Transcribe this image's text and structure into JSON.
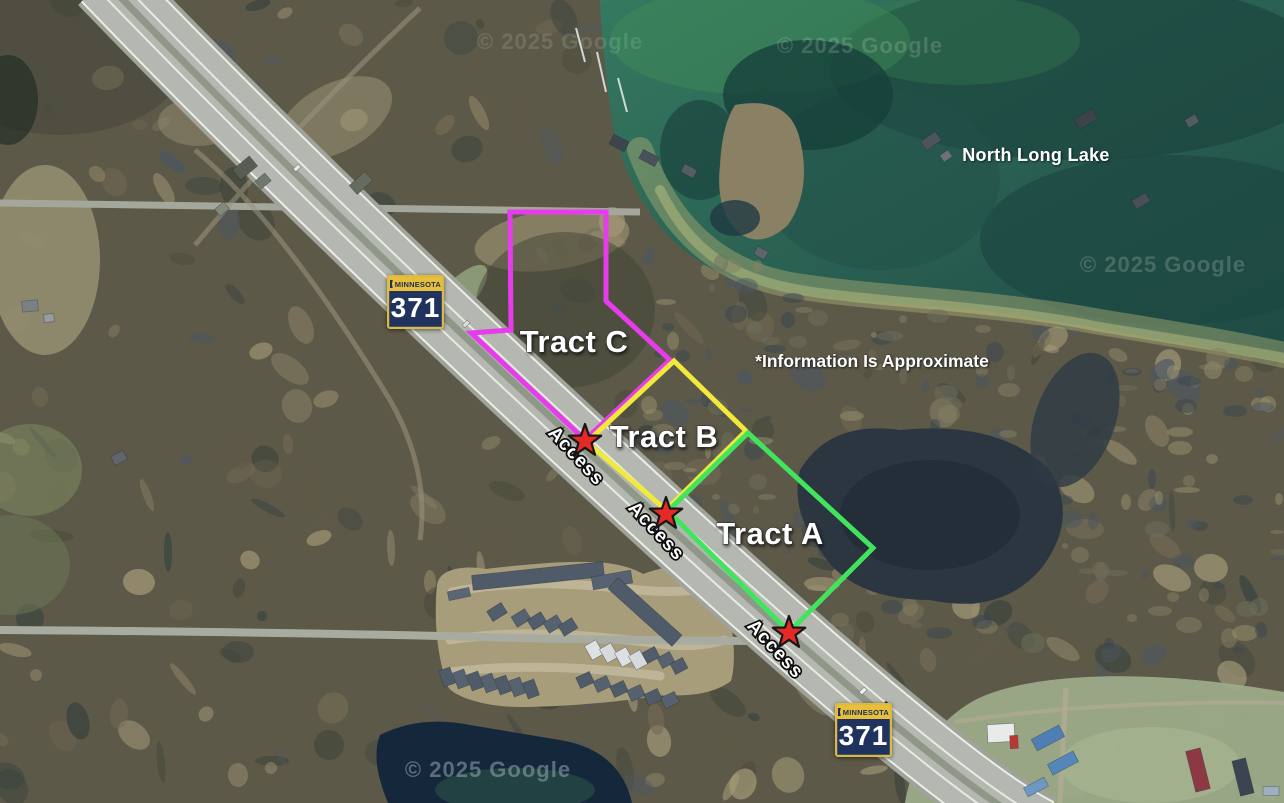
{
  "map": {
    "lake_label": {
      "text": "North Long Lake",
      "x": 1036,
      "y": 161
    },
    "disclaimer": {
      "text": "*Information Is Approximate",
      "x": 872,
      "y": 367
    },
    "watermarks": [
      {
        "text": "© 2025 Google",
        "x": 560,
        "y": 49,
        "opacity": 0.16,
        "color": "#cfe0d8"
      },
      {
        "text": "© 2025 Google",
        "x": 860,
        "y": 53,
        "opacity": 0.2,
        "color": "#cfe0d8"
      },
      {
        "text": "© 2025 Google",
        "x": 1163,
        "y": 272,
        "opacity": 0.22,
        "color": "#d4e2cf"
      },
      {
        "text": "© 2025 Google",
        "x": 488,
        "y": 777,
        "opacity": 0.5,
        "color": "#9fb3bd"
      }
    ],
    "shields": [
      {
        "state": "MINNESOTA",
        "number": "371",
        "x": 387,
        "y": 275
      },
      {
        "state": "MINNESOTA",
        "number": "371",
        "x": 835,
        "y": 703
      }
    ],
    "tracts": [
      {
        "name": "Tract C",
        "color": "#e73cec",
        "label_x": 574,
        "label_y": 352,
        "points": [
          [
            510,
            212
          ],
          [
            606,
            212
          ],
          [
            606,
            301
          ],
          [
            670,
            360
          ],
          [
            585,
            440
          ],
          [
            471,
            333
          ],
          [
            511,
            330
          ]
        ]
      },
      {
        "name": "Tract B",
        "color": "#f2e93b",
        "label_x": 664,
        "label_y": 447,
        "points": [
          [
            674,
            361
          ],
          [
            746,
            431
          ],
          [
            666,
            510
          ],
          [
            587,
            442
          ]
        ]
      },
      {
        "name": "Tract A",
        "color": "#41e45c",
        "label_x": 770,
        "label_y": 544,
        "points": [
          [
            748,
            433
          ],
          [
            873,
            548
          ],
          [
            789,
            632
          ],
          [
            668,
            511
          ]
        ]
      }
    ],
    "access_points": [
      {
        "label": "Access",
        "star_x": 585,
        "star_y": 441,
        "text_x": 572,
        "text_y": 460,
        "angle": 47
      },
      {
        "label": "Access",
        "star_x": 666,
        "star_y": 514,
        "text_x": 652,
        "text_y": 535,
        "angle": 47
      },
      {
        "label": "Access",
        "star_x": 789,
        "star_y": 633,
        "text_x": 771,
        "text_y": 653,
        "angle": 47
      }
    ],
    "star_color": "#e32a24",
    "star_outline": "#161616",
    "outline_width": 5
  }
}
